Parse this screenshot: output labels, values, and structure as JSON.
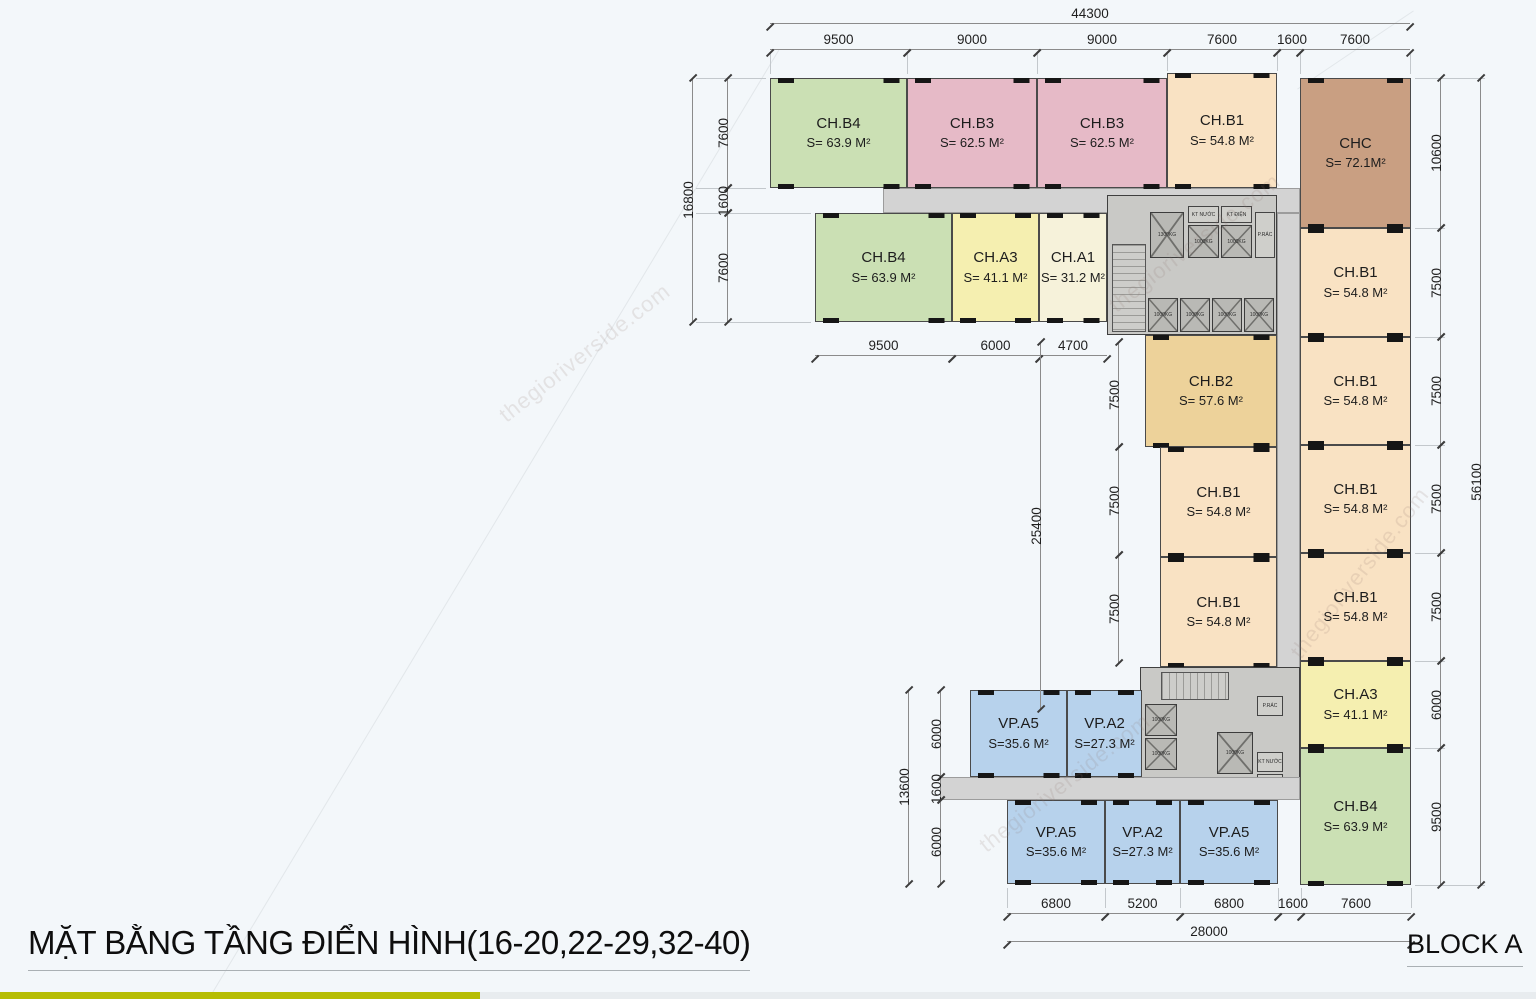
{
  "title": "MẶT BẰNG TẦNG ĐIỂN HÌNH(16-20,22-29,32-40)",
  "block_label": "BLOCK A",
  "watermark_text": "thegioriverside.com",
  "palette": {
    "green": "#cbe0b4",
    "pink": "#e6bac7",
    "peach": "#f9e2c3",
    "brown": "#c99f82",
    "yellow": "#f5efb0",
    "cream": "#f6f2da",
    "gold": "#edd29a",
    "blue": "#b7d2ec",
    "corridor": "#d3d3d3",
    "core": "#c9c9c6",
    "accent_bar": "#b6bd04",
    "accent_bar_right": "#e8ecef"
  },
  "rooms": [
    {
      "name": "CH.B4",
      "area": "S= 63.9 M²",
      "color": "green"
    },
    {
      "name": "CH.B3",
      "area": "S= 62.5 M²",
      "color": "pink"
    },
    {
      "name": "CH.B3",
      "area": "S= 62.5 M²",
      "color": "pink"
    },
    {
      "name": "CH.B1",
      "area": "S= 54.8 M²",
      "color": "peach"
    },
    {
      "name": "CHC",
      "area": "S= 72.1M²",
      "color": "brown"
    },
    {
      "name": "CH.B4",
      "area": "S= 63.9 M²",
      "color": "green"
    },
    {
      "name": "CH.A3",
      "area": "S= 41.1 M²",
      "color": "yellow"
    },
    {
      "name": "CH.A1",
      "area": "S= 31.2 M²",
      "color": "cream"
    },
    {
      "name": "CH.B2",
      "area": "S= 57.6 M²",
      "color": "gold"
    },
    {
      "name": "CH.B1",
      "area": "S= 54.8 M²",
      "color": "peach"
    },
    {
      "name": "CH.B1",
      "area": "S= 54.8 M²",
      "color": "peach"
    },
    {
      "name": "CH.B1",
      "area": "S= 54.8 M²",
      "color": "peach"
    },
    {
      "name": "CH.B1",
      "area": "S= 54.8 M²",
      "color": "peach"
    },
    {
      "name": "CH.B1",
      "area": "S= 54.8 M²",
      "color": "peach"
    },
    {
      "name": "CH.B1",
      "area": "S= 54.8 M²",
      "color": "peach"
    },
    {
      "name": "CH.A3",
      "area": "S= 41.1 M²",
      "color": "yellow"
    },
    {
      "name": "CH.B4",
      "area": "S= 63.9 M²",
      "color": "green"
    },
    {
      "name": "VP.A5",
      "area": "S=35.6 M²",
      "color": "blue"
    },
    {
      "name": "VP.A2",
      "area": "S=27.3 M²",
      "color": "blue"
    },
    {
      "name": "VP.A5",
      "area": "S=35.6 M²",
      "color": "blue"
    },
    {
      "name": "VP.A2",
      "area": "S=27.3 M²",
      "color": "blue"
    },
    {
      "name": "VP.A5",
      "area": "S=35.6 M²",
      "color": "blue"
    }
  ],
  "core": {
    "elev_small": "1000KG",
    "elev_big": "1300KG",
    "water": "KT NƯỚC",
    "electric": "KT ĐIỆN",
    "trash": "P.RÁC"
  },
  "dimensions": {
    "top_total": "44300",
    "top_segments": [
      "9500",
      "9000",
      "9000",
      "7600",
      "1600",
      "7600"
    ],
    "left_total": "16800",
    "left_segments": [
      "7600",
      "1600",
      "7600"
    ],
    "row2_segments": [
      "9500",
      "6000",
      "4700"
    ],
    "mid_total": "25400",
    "mid_segments": [
      "7500",
      "7500",
      "7500"
    ],
    "lower_left_total": "13600",
    "lower_left_segments": [
      "6000",
      "1600",
      "6000"
    ],
    "bottom_total": "28000",
    "bottom_segments": [
      "6800",
      "5200",
      "6800",
      "1600",
      "7600"
    ],
    "right_total": "56100",
    "right_segments": [
      "10600",
      "7500",
      "7500",
      "7500",
      "7500",
      "6000",
      "9500"
    ]
  }
}
